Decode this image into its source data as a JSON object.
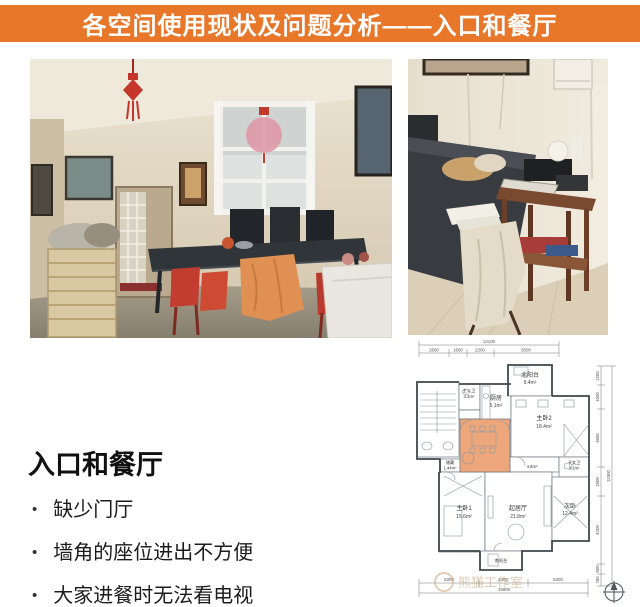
{
  "title": "各空间使用现状及问题分析——入口和餐厅",
  "section": {
    "heading": "入口和餐厅",
    "bullets": [
      "缺少门厅",
      "墙角的座位进出不方便",
      "大家进餐时无法看电视"
    ]
  },
  "colors": {
    "title_bar": "#E8772A",
    "highlight_area": "#EDA77B",
    "plan_line": "#6B7480",
    "watermark": "#C8A57D"
  },
  "floorplan": {
    "watermark": "熊猫工作室",
    "hall_area": "4.6m²",
    "rooms": [
      {
        "label": "北阳台",
        "area": "9.4m²"
      },
      {
        "label": "厨房",
        "area": "5.1m²"
      },
      {
        "label": "主人卫",
        "area": "4.2m²"
      },
      {
        "label": "主卧2",
        "area": "18.4m²"
      },
      {
        "label": "主卧1",
        "area": "15.6m²"
      },
      {
        "label": "起居厅",
        "area": "21.8m²"
      },
      {
        "label": "次卧",
        "area": "12.4m²"
      },
      {
        "label": "子女卫",
        "area": "3.1m²"
      },
      {
        "label": "储藏",
        "area": "1.44m²"
      },
      {
        "label": "南阳台",
        "area": ""
      }
    ],
    "dims_top": {
      "total": "12100",
      "segments": [
        "2600",
        "1600",
        "2300",
        "5600"
      ]
    },
    "dims_right": {
      "total": "11500",
      "segments": [
        "1200",
        "1500",
        "3600",
        "1800",
        "4200",
        "600",
        "750"
      ]
    },
    "dims_bottom": {
      "total": "15800",
      "segments": [
        "5300",
        "4300",
        "5300"
      ]
    }
  }
}
